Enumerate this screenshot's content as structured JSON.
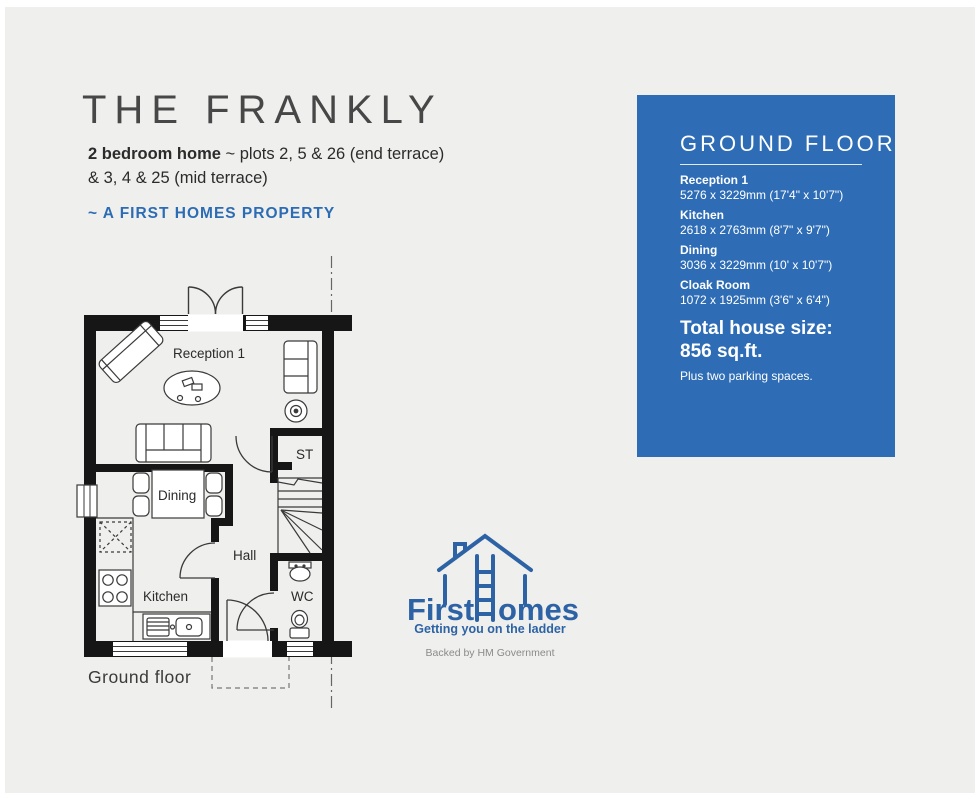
{
  "header": {
    "title": "THE FRANKLY",
    "subtitle_bold": "2 bedroom home",
    "subtitle_rest": " ~ plots 2, 5 & 26 (end terrace)",
    "subtitle_line2": "& 3, 4 & 25 (mid terrace)",
    "property_tag": "~ A FIRST HOMES  PROPERTY"
  },
  "panel": {
    "title": "GROUND FLOOR",
    "rooms": [
      {
        "name": "Reception 1",
        "dims": "5276 x 3229mm (17'4\" x 10'7\")"
      },
      {
        "name": "Kitchen",
        "dims": "2618 x 2763mm (8'7\" x 9'7\")"
      },
      {
        "name": "Dining",
        "dims": "3036 x 3229mm (10' x 10'7\")"
      },
      {
        "name": "Cloak Room",
        "dims": "1072 x 1925mm (3'6\" x 6'4\")"
      }
    ],
    "total_label": "Total house size:",
    "total_value": "856 sq.ft.",
    "parking": "Plus two parking spaces."
  },
  "plan": {
    "labels": {
      "reception": "Reception 1",
      "dining": "Dining",
      "kitchen": "Kitchen",
      "hall": "Hall",
      "st": "ST",
      "wc": "WC"
    },
    "caption": "Ground floor"
  },
  "logo": {
    "first": "First",
    "homes_rest": "omes",
    "tagline": "Getting you on the ladder",
    "backed": "Backed by HM Government"
  },
  "colors": {
    "panel_blue": "#2e6db5",
    "accent_blue": "#2d63a5",
    "background": "#efefed"
  }
}
